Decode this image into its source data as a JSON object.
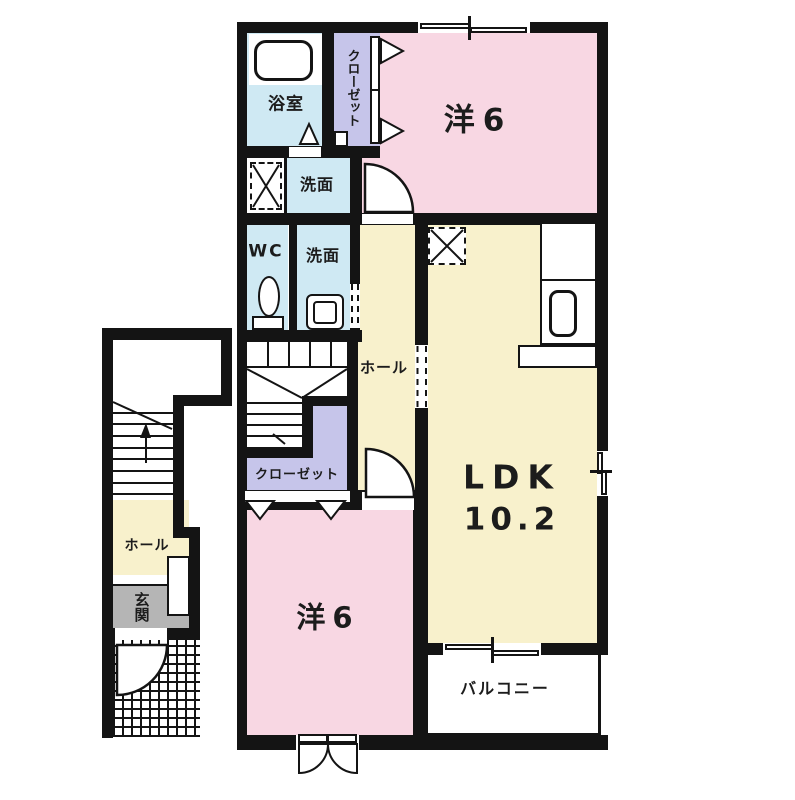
{
  "title": "apartment-floor-plan-2f",
  "colors": {
    "wall": "#141414",
    "pink": "#f8d7e3",
    "yellow": "#f8f1cc",
    "blue": "#cfe9f3",
    "purple": "#c6c5ea",
    "gray": "#b5b5b5"
  },
  "rooms": {
    "bathroom": {
      "label": "浴室"
    },
    "closet_top": {
      "label": "クローゼット"
    },
    "bedroom_top": {
      "label": "洋6"
    },
    "washroom_upper": {
      "label": "洗面"
    },
    "wc": {
      "label": "WC"
    },
    "washroom_lower": {
      "label": "洗面"
    },
    "hall_main": {
      "label": "ホール"
    },
    "closet_mid": {
      "label": "クローゼット"
    },
    "ldk": {
      "label": "LDK",
      "size": "10.2"
    },
    "bedroom_bottom": {
      "label": "洋6"
    },
    "balcony": {
      "label": "バルコニー"
    },
    "entry_hall": {
      "label": "ホール"
    },
    "entrance": {
      "label": "玄関"
    }
  }
}
